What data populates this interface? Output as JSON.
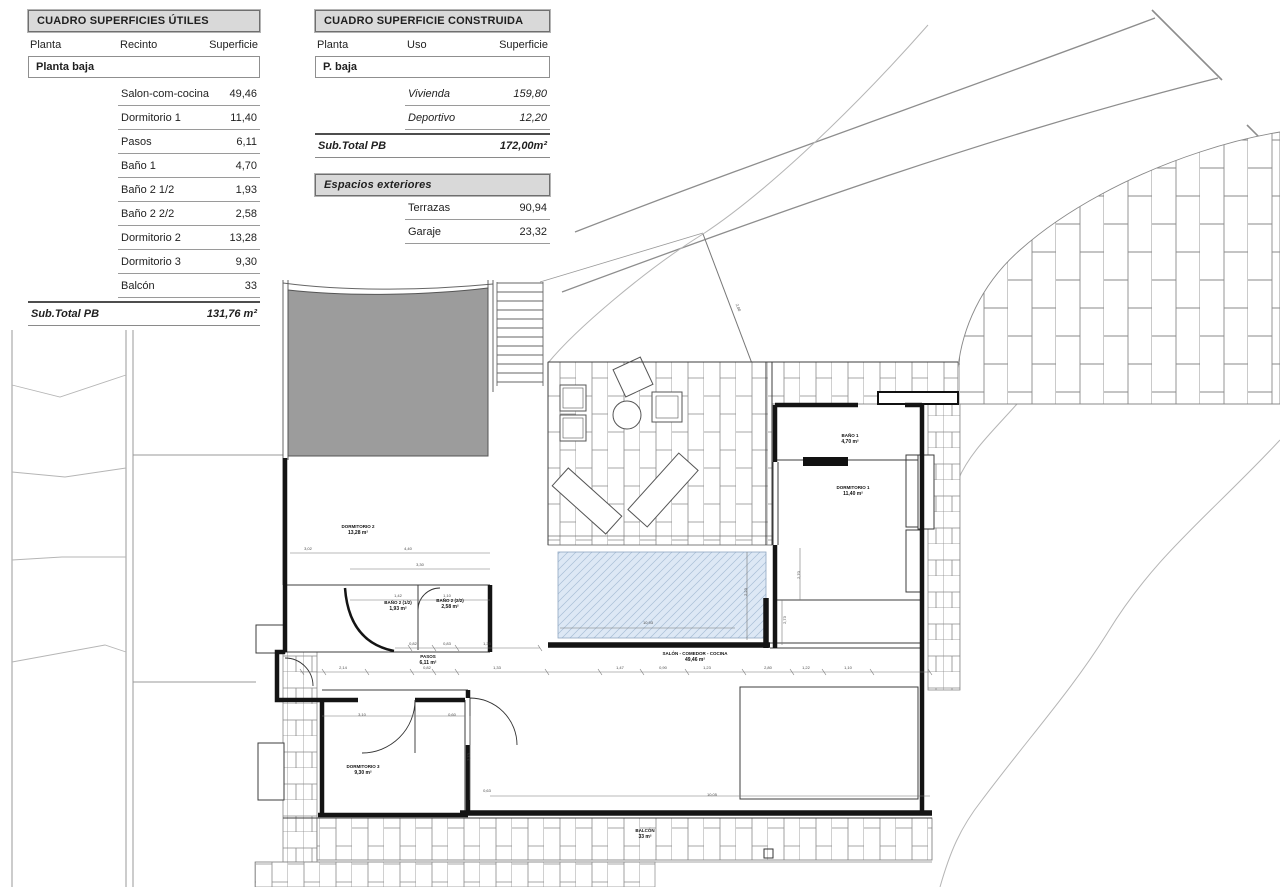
{
  "colors": {
    "wall": "#141414",
    "thin": "#3c3c3c",
    "hatch": "#8a8a8a",
    "contour": "#b5b5b5",
    "boundary": "#8d8d8d",
    "roof": "#9c9c9c",
    "pool_fill": "#dde8f5",
    "pool_line": "#a8bed6",
    "tbl_bg": "#d9d9d9",
    "tbl_border": "#6f6f6f",
    "ink": "#1f1f1f"
  },
  "tables": {
    "utiles": {
      "title": "CUADRO SUPERFICIES ÚTILES",
      "col1": "Planta",
      "col2": "Recinto",
      "col3": "Superficie",
      "group": "Planta baja",
      "rows": [
        {
          "label": "Salon-com-cocina",
          "value": "49,46"
        },
        {
          "label": "Dormitorio 1",
          "value": "11,40"
        },
        {
          "label": "Pasos",
          "value": "6,11"
        },
        {
          "label": "Baño 1",
          "value": "4,70"
        },
        {
          "label": "Baño 2 1/2",
          "value": "1,93"
        },
        {
          "label": "Baño 2 2/2",
          "value": "2,58"
        },
        {
          "label": "Dormitorio 2",
          "value": "13,28"
        },
        {
          "label": "Dormitorio 3",
          "value": "9,30"
        },
        {
          "label": "Balcón",
          "value": "33"
        }
      ],
      "subtotal_label": "Sub.Total PB",
      "subtotal_value": "131,76 m²"
    },
    "construida": {
      "title": "CUADRO SUPERFICIE CONSTRUIDA",
      "col1": "Planta",
      "col2": "Uso",
      "col3": "Superficie",
      "group": "P. baja",
      "rows": [
        {
          "label": "Vivienda",
          "value": "159,80"
        },
        {
          "label": "Deportivo",
          "value": "12,20"
        }
      ],
      "subtotal_label": "Sub.Total PB",
      "subtotal_value": "172,00m²"
    },
    "exteriores": {
      "title": "Espacios exteriores",
      "rows": [
        {
          "label": "Terrazas",
          "value": "90,94"
        },
        {
          "label": "Garaje",
          "value": "23,32"
        }
      ]
    }
  },
  "plan": {
    "room_labels": [
      {
        "name": "DORMITORIO 2",
        "area": "13,28 m²",
        "x": 358,
        "y": 528
      },
      {
        "name": "BAÑO 2 (1/2)",
        "area": "1,93 m²",
        "x": 398,
        "y": 604
      },
      {
        "name": "BAÑO 2 (2/2)",
        "area": "2,58 m²",
        "x": 450,
        "y": 602
      },
      {
        "name": "PASOS",
        "area": "6,11 m²",
        "x": 428,
        "y": 658
      },
      {
        "name": "SALÓN - COMEDOR - COCINA",
        "area": "49,46 m²",
        "x": 695,
        "y": 655
      },
      {
        "name": "BAÑO 1",
        "area": "4,70 m²",
        "x": 850,
        "y": 437
      },
      {
        "name": "DORMITORIO 1",
        "area": "11,40 m²",
        "x": 853,
        "y": 489
      },
      {
        "name": "DORMITORIO 3",
        "area": "9,30 m²",
        "x": 363,
        "y": 768
      },
      {
        "name": "BALCÓN",
        "area": "33 m²",
        "x": 645,
        "y": 832
      }
    ],
    "dimensions": [
      {
        "t": "3,02",
        "x": 308,
        "y": 550
      },
      {
        "t": "4,40",
        "x": 408,
        "y": 550
      },
      {
        "t": "3,30",
        "x": 420,
        "y": 566
      },
      {
        "t": "1,42",
        "x": 398,
        "y": 597
      },
      {
        "t": "1,10",
        "x": 447,
        "y": 597
      },
      {
        "t": "0,82",
        "x": 413,
        "y": 645
      },
      {
        "t": "0,83",
        "x": 447,
        "y": 645
      },
      {
        "t": "1,33",
        "x": 487,
        "y": 645
      },
      {
        "t": "2,14",
        "x": 343,
        "y": 669
      },
      {
        "t": "0,82",
        "x": 427,
        "y": 669
      },
      {
        "t": "1,33",
        "x": 497,
        "y": 669
      },
      {
        "t": "1,47",
        "x": 620,
        "y": 669
      },
      {
        "t": "0,90",
        "x": 663,
        "y": 669
      },
      {
        "t": "1,23",
        "x": 707,
        "y": 669
      },
      {
        "t": "2,80",
        "x": 768,
        "y": 669
      },
      {
        "t": "1,22",
        "x": 806,
        "y": 669
      },
      {
        "t": "1,10",
        "x": 848,
        "y": 669
      },
      {
        "t": "3,10",
        "x": 362,
        "y": 716
      },
      {
        "t": "0,60",
        "x": 452,
        "y": 716
      },
      {
        "t": "2,73",
        "x": 470,
        "y": 757,
        "r": -90
      },
      {
        "t": "0,63",
        "x": 487,
        "y": 792
      },
      {
        "t": "10,05",
        "x": 712,
        "y": 796
      },
      {
        "t": "10,93",
        "x": 648,
        "y": 624
      },
      {
        "t": "2,23",
        "x": 747,
        "y": 592,
        "r": -90
      },
      {
        "t": "2,00",
        "x": 737,
        "y": 308,
        "r": 70
      },
      {
        "t": "2,70",
        "x": 800,
        "y": 575,
        "r": -90
      },
      {
        "t": "2,73",
        "x": 786,
        "y": 620,
        "r": -90
      }
    ]
  }
}
